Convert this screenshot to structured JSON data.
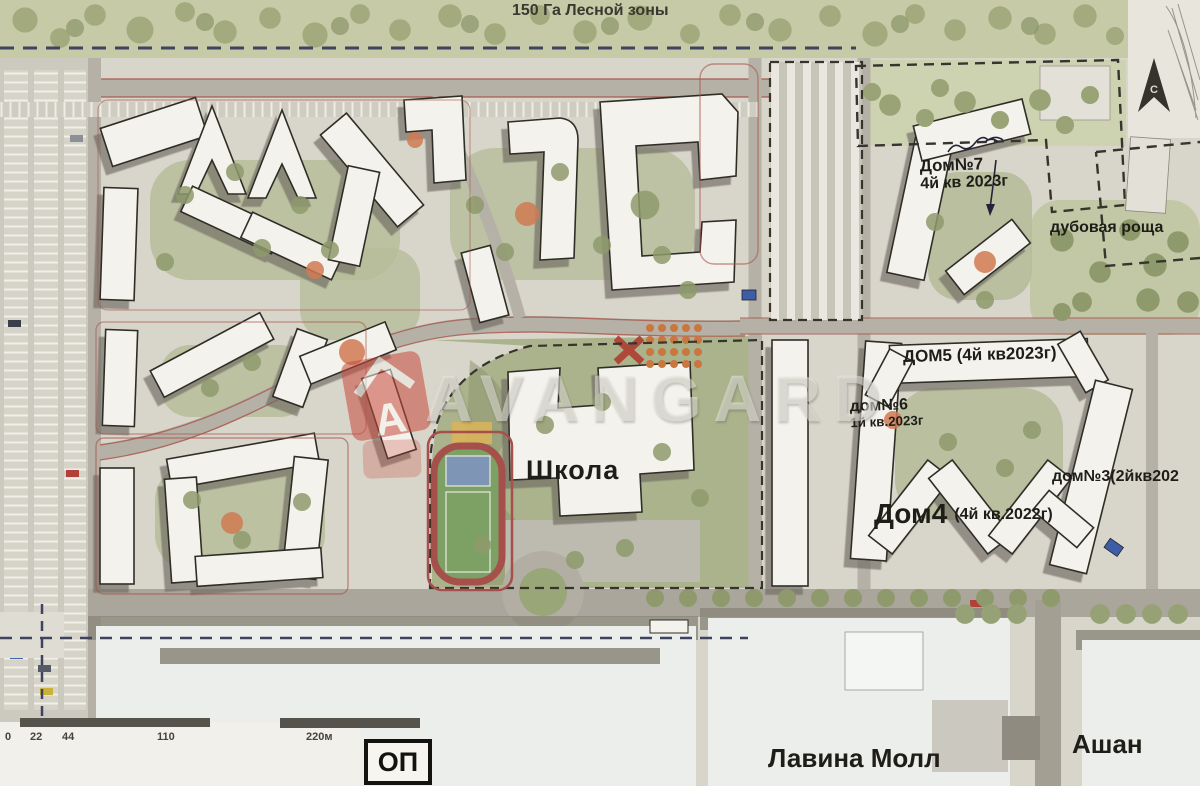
{
  "map": {
    "forest_label": "150 Га Лесной зоны",
    "labels": {
      "house7_name": "Дом№7",
      "house7_term": "4й кв 2023г",
      "oak_grove": "дубовая роща",
      "house5": "ДОМ5 (4й кв2023г)",
      "house6_name": "дом№6",
      "house6_term": "1й кв.2023г",
      "house3": "дом№3(2йкв202",
      "house4_name": "Дом4",
      "house4_term": "(4й кв.2022г)",
      "school": "Школа",
      "lavina_mall": "Лавина Молл",
      "ashan": "Ашан",
      "op": "ОП"
    },
    "scalebar": {
      "ticks": [
        "0",
        "22",
        "44",
        "110",
        "220м"
      ]
    },
    "watermark": {
      "text": "AVANGARD",
      "logo_letter": "А"
    },
    "north_arrow_letter": "С",
    "colors": {
      "base": "#d8d5cb",
      "forest": "#c6caa6",
      "tree": "#8e9a6c",
      "courtyard": "#b7bd9a",
      "road": "#b5b1a7",
      "building": "#f4f2ec",
      "building_outline": "#2f2d26",
      "shadow": "#6e6b62",
      "parcel_red": "#a8564c",
      "boundary_navy": "#3e4360",
      "playground_orange": "#d07a52",
      "field_green": "#7da065",
      "track_red": "#a5504a",
      "court_blue": "#7e95b5",
      "watermark_red": "#c94a3c"
    }
  }
}
